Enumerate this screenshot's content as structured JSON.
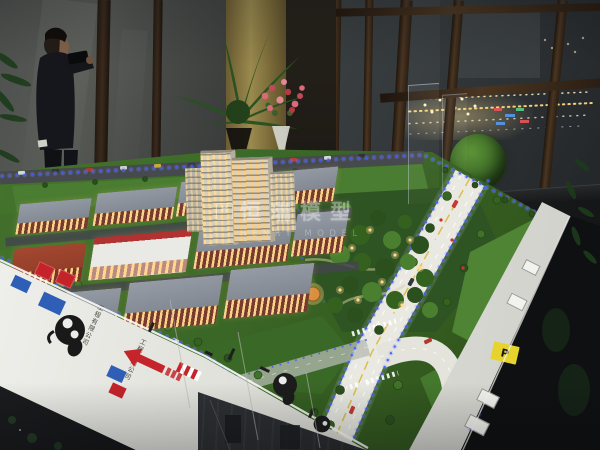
{
  "watermark": {
    "logo": "H",
    "title_cn": "恒瑞模型",
    "subtitle_en": "HENRY MODEL"
  },
  "base_left": {
    "company_text": "工程有限公司"
  },
  "base_right": {
    "parking_label": "P"
  },
  "palette": {
    "led_blue": "#3d5cff",
    "road_light": "#e9e9e2",
    "lawn_green": "#3e6b2a",
    "brick_red": "#984327",
    "roof_gray": "#8d939c",
    "window_glow": "#ffd98e",
    "base_white": "#ecece6",
    "night_light_warm": "#ffd87e"
  }
}
